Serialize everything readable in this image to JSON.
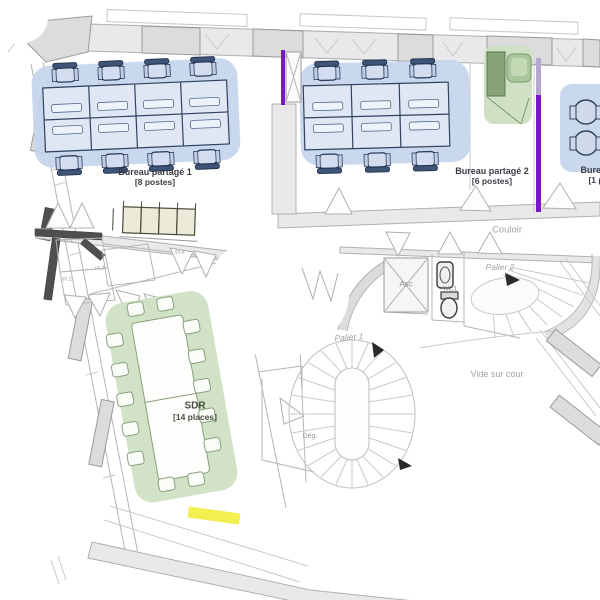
{
  "rooms": {
    "bureau_partage_1": {
      "name": "Bureau partagé 1",
      "capacity": "[8 postes]"
    },
    "bureau_partage_2": {
      "name": "Bureau partagé 2",
      "capacity": "[6 postes]"
    },
    "bureau_3": {
      "name": "Bureau",
      "capacity": "[1 p"
    },
    "sdr": {
      "name": "SDR",
      "capacity": "[14 places]"
    },
    "couloir": {
      "name": "Couloir"
    },
    "palier_1": {
      "name": "Palier 1"
    },
    "palier_2": {
      "name": "Palier 2"
    },
    "ascenseur": {
      "name": "Asc"
    },
    "wc1": {
      "name": "WC1"
    },
    "vide_sur_cour": {
      "name": "Vide sur cour"
    },
    "degagement": {
      "name": "Dég."
    },
    "placards": {
      "pl1": "Pl.1",
      "pl2": "Pl.2",
      "pl3": "Pl.3",
      "pl4": "Pl.4"
    }
  },
  "colors": {
    "shared_office_fill": "#c6d5ed",
    "meeting_room_fill": "#cfe0c3",
    "kitchenette_fill": "#cfe0c3",
    "desk_outline": "#2f4360",
    "wall_grey": "#e9e9e9",
    "dark_wall": "#4f4f4f",
    "accent_purple": "#7a16c9",
    "highlight_yellow": "#f3ef4e",
    "label_dark": "#3b3b46",
    "label_grey": "#a2a2a2"
  }
}
